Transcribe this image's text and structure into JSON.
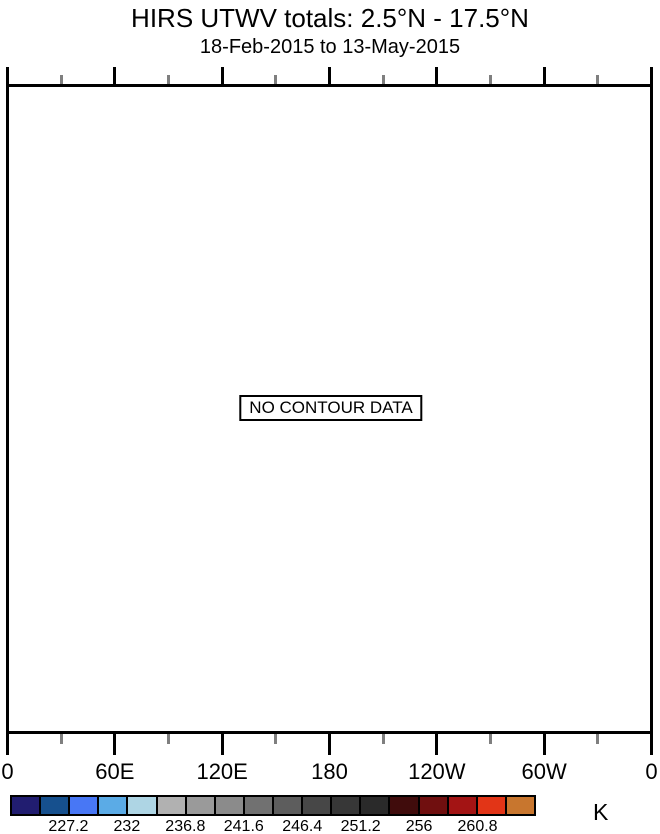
{
  "chart_data": {
    "type": "heatmap",
    "title": "HIRS UTWV totals: 2.5°N - 17.5°N",
    "subtitle": "18-Feb-2015 to 13-May-2015",
    "annotation": "NO CONTOUR DATA",
    "values": [],
    "no_data": true,
    "x_axis": {
      "tick_labels": [
        "0",
        "60E",
        "120E",
        "180",
        "120W",
        "60W",
        "0"
      ],
      "minor_ticks_between_majors": 1,
      "grid": false
    },
    "colorbar": {
      "unit_label": "K",
      "tick_labels": [
        "227.2",
        "232",
        "236.8",
        "241.6",
        "246.4",
        "251.2",
        "256",
        "260.8"
      ],
      "colors": [
        "#211d70",
        "#16508e",
        "#4877f5",
        "#5babe6",
        "#aed5e4",
        "#b1b1b1",
        "#9a9a9a",
        "#8b8b8b",
        "#717171",
        "#5d5d5d",
        "#474747",
        "#373737",
        "#2a2a2a",
        "#400c0c",
        "#700f0f",
        "#a31414",
        "#e23517",
        "#c8762e"
      ],
      "tick_label_every_n_cells": 2,
      "first_labeled_boundary_index": 2
    },
    "layout": {
      "legend_position": "bottom",
      "plot_border_color": "#000000",
      "minor_tick_color": "#7f7f7f",
      "background_color": "#ffffff"
    }
  }
}
